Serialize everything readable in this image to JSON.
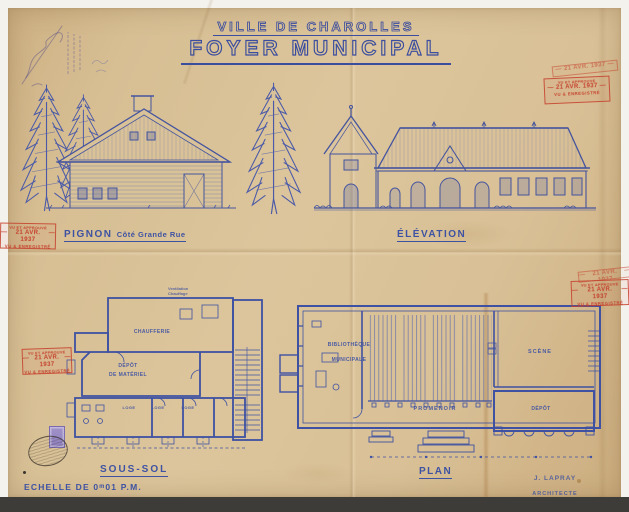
{
  "header": {
    "city_title": "VILLE DE CHAROLLES",
    "project_title": "FOYER MUNICIPAL"
  },
  "sections": {
    "pignon_label": "PIGNON",
    "pignon_sublabel": "Côté Grande Rue",
    "elevation_label": "ÉLÉVATION",
    "sous_sol_label": "SOUS-SOL",
    "plan_label": "PLAN"
  },
  "rooms": {
    "chaufferie": "CHAUFFERIE",
    "depot_line1": "DÉPÔT",
    "depot_line2": "DE MATÉRIEL",
    "loge": "LOGE",
    "bibliotheque_line1": "BIBLIOTHÈQUE",
    "bibliotheque_line2": "MUNICIPALE",
    "scene": "SCÈNE",
    "promenoir": "PROMENOIR",
    "depot": "DÉPÔT"
  },
  "notes": {
    "note1": "Ventilation",
    "note2": "Chauffage"
  },
  "stamps": {
    "top_line": "VU ET APPROUVÉ",
    "date_line": "21 AVR. 1937",
    "bottom_line": "VU & ENREGISTRÉ",
    "dash": "—"
  },
  "footer": {
    "scale_label": "ECHELLE DE 0ᵐ01 P.M.",
    "architect_name": "J. LAPRAY",
    "architect_title": "ARCHITECTE"
  },
  "colors": {
    "ink_blue": "#3a4d9e",
    "stamp_red": "#c4402c",
    "paper": "#d8c094"
  }
}
